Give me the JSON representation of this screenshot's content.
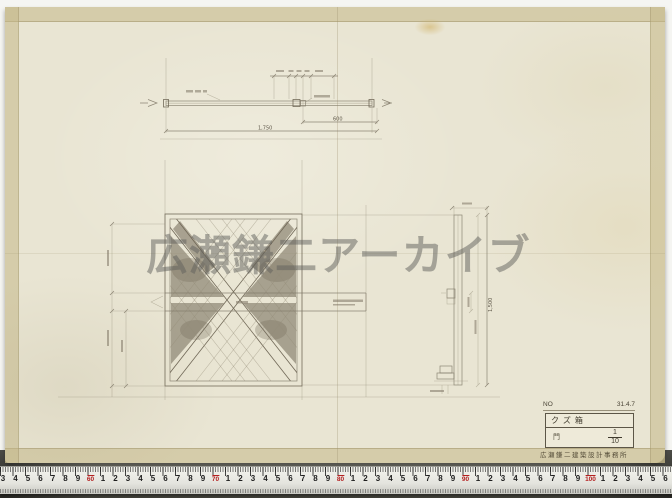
{
  "watermark": {
    "text": "広瀬鎌二アーカイブ"
  },
  "title_block": {
    "no_label": "NO",
    "date": "31.4.7",
    "title": "クズ箱",
    "item_label": "門",
    "scale_numerator": "1",
    "scale_denominator": "10",
    "stamp": "広瀬鎌二建築設計事務所"
  },
  "dims": {
    "top_rail": "600",
    "top_overall": "1,750",
    "side_height": "1,500"
  },
  "ruler": {
    "start_digit": 3,
    "pitch_px": 12.5,
    "origin_px": 3,
    "red_labels": [
      "60",
      "70",
      "80",
      "90",
      "100"
    ]
  },
  "colors": {
    "paper": "#e9e5d3",
    "tape_edge": "#c4b889",
    "pencil": "#837b6a",
    "ruler_red": "#b42020",
    "photo_background": "#6e6d64"
  }
}
